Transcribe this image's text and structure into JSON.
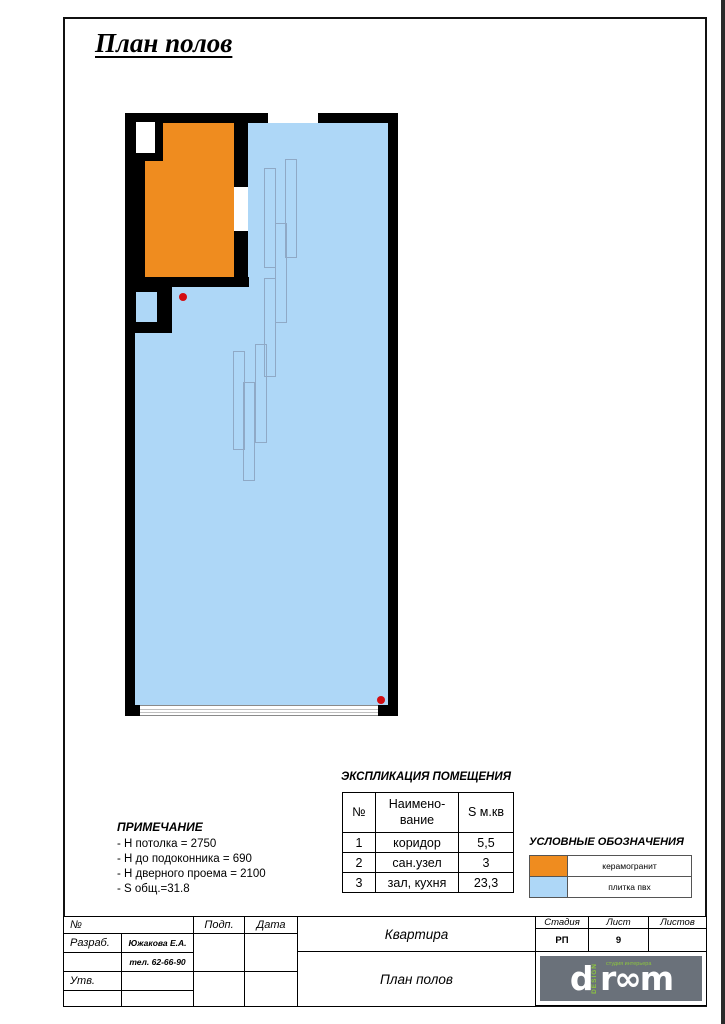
{
  "page": {
    "title": "План полов"
  },
  "colors": {
    "wall": "#000000",
    "ceramic": "#ef8c1f",
    "pvc": "#aed7f7",
    "marker": "#d40d12",
    "plank_outline": "#8fa9c6",
    "logo_bg": "#6a717a",
    "logo_green": "#8dc63f"
  },
  "explication": {
    "title": "ЭКСПЛИКАЦИЯ ПОМЕЩЕНИЯ",
    "headers": {
      "num": "№",
      "name": "Наимено-\nвание",
      "area": "S м.кв"
    },
    "rows": [
      {
        "num": "1",
        "name": "коридор",
        "area": "5,5"
      },
      {
        "num": "2",
        "name": "сан.узел",
        "area": "3"
      },
      {
        "num": "3",
        "name": "зал, кухня",
        "area": "23,3"
      }
    ]
  },
  "notes": {
    "title": "ПРИМЕЧАНИЕ",
    "lines": [
      "- Н потолка = 2750",
      "- Н до подоконника = 690",
      "- Н дверного проема = 2100",
      "- S общ.=31.8"
    ]
  },
  "legend": {
    "title": "УСЛОВНЫЕ ОБОЗНАЧЕНИЯ",
    "items": [
      {
        "label": "керамогранит",
        "color": "#ef8c1f"
      },
      {
        "label": "плитка пвх",
        "color": "#aed7f7"
      }
    ]
  },
  "titleblock": {
    "num_label": "№",
    "sign_label": "Подп.",
    "date_label": "Дата",
    "developed_label": "Разраб.",
    "developer_name": "Южакова Е.А.",
    "developer_phone": "тел. 62-66-90",
    "approved_label": "Утв.",
    "project": "Квартира",
    "sheet_title": "План полов",
    "stage_label": "Стадия",
    "sheet_label": "Лист",
    "sheets_label": "Листов",
    "stage_value": "РП",
    "sheet_value": "9",
    "sheets_value": "",
    "logo": {
      "d": "d",
      "design": "DESIGN",
      "rest": "r∞m",
      "tagline": "студия интерьера"
    }
  }
}
